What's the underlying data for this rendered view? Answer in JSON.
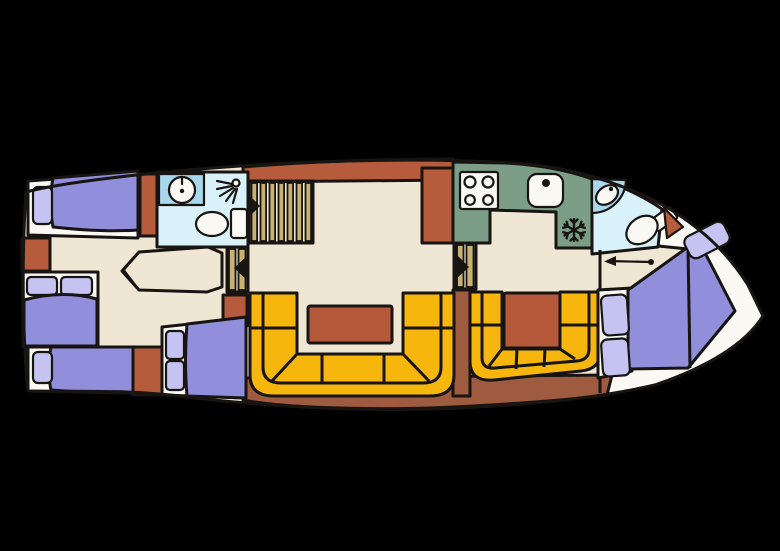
{
  "diagram": {
    "title": "Motor yacht interior deck floor plan",
    "type": "boat-floor-plan",
    "orientation": {
      "bow": "right",
      "stern": "left"
    }
  },
  "palette": {
    "background": "#000000",
    "hull": "#FBF9F3",
    "floor": "#F0E6D4",
    "outline": "#171412",
    "berth": "#918EDC",
    "pillow": "#C5C3F1",
    "cabinet": "#B65C3C",
    "seating": "#F6B60B",
    "table": "#B6593A",
    "galley_counter": "#7C9E86",
    "bathroom": "#D9F1F9",
    "sink_counter": "#A9D7EB",
    "steps": "#C8B272",
    "deck_base": "#9E5B3F"
  },
  "rooms": [
    {
      "name": "aft cabin with three berths",
      "features": [
        "single berth port",
        "double berth",
        "single berth starboard",
        "wardrobes",
        "dressing area"
      ]
    },
    {
      "name": "aft bathroom",
      "features": [
        "washbasin",
        "shower",
        "toilet"
      ]
    },
    {
      "name": "saloon",
      "features": [
        "companionway stairs",
        "entry steps",
        "U-shaped dinette",
        "saloon table",
        "sideboard"
      ]
    },
    {
      "name": "galley",
      "features": [
        "four burner stove",
        "galley sink",
        "fridge freezer"
      ]
    },
    {
      "name": "second dinette",
      "features": [
        "U-shaped bench",
        "dinette table"
      ]
    },
    {
      "name": "bow bathroom",
      "features": [
        "corner washbasin",
        "toilet",
        "door"
      ]
    },
    {
      "name": "bow cabin",
      "features": [
        "double berth",
        "pillows",
        "sliding access"
      ]
    }
  ],
  "icons": [
    "shower-icon",
    "washbasin-icon",
    "toilet-icon",
    "stove-icon",
    "galley-sink-icon",
    "snowflake-icon",
    "stairs-icon",
    "door-arrow-icon",
    "slide-arrow-icon"
  ]
}
